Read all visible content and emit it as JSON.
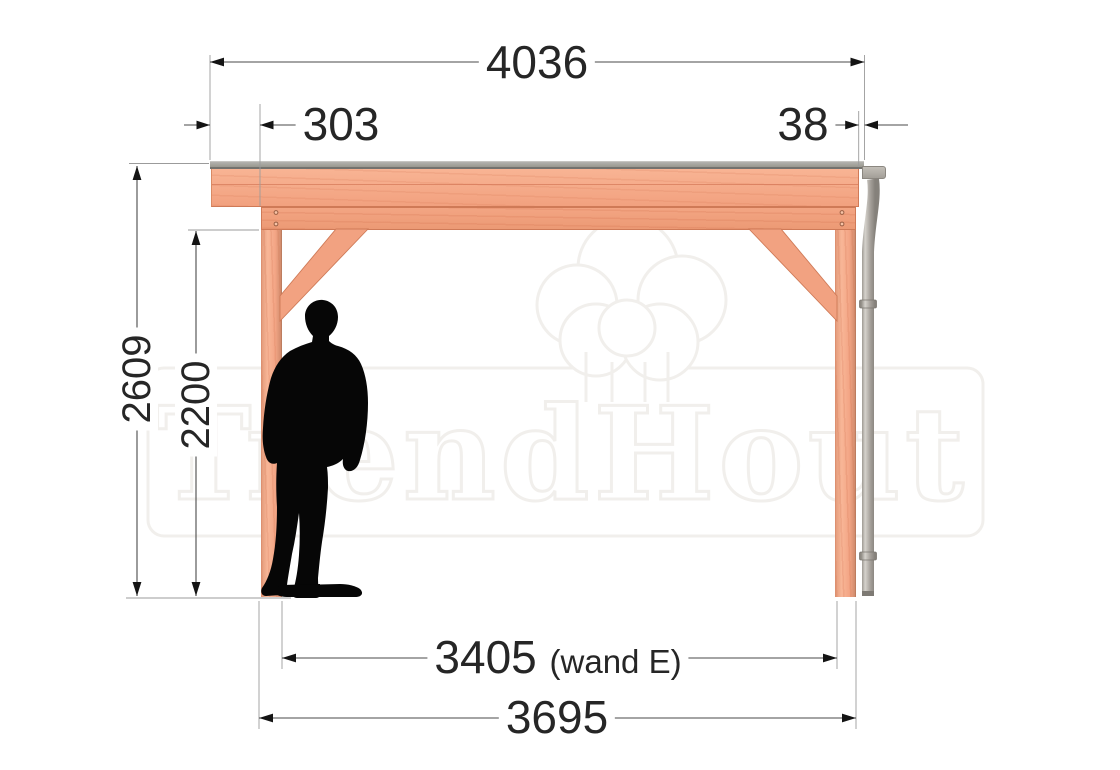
{
  "drawing": {
    "dimensions": {
      "top_width": "4036",
      "left_overhang": "303",
      "right_overhang": "38",
      "overall_height": "2609",
      "clear_height": "2200",
      "wall_span_value": "3405",
      "wall_span_note": "(wand E)",
      "post_span": "3695"
    },
    "watermark": {
      "brand": "TrendHout"
    },
    "colors": {
      "wood": "#f4a585",
      "roof_gray": "#9e9d99",
      "pipe_gray": "#a49f99",
      "dimension_text": "#262626",
      "watermark_gray": "#f1efec"
    },
    "icons": {
      "tree_logo": "tree-logo-icon"
    }
  }
}
